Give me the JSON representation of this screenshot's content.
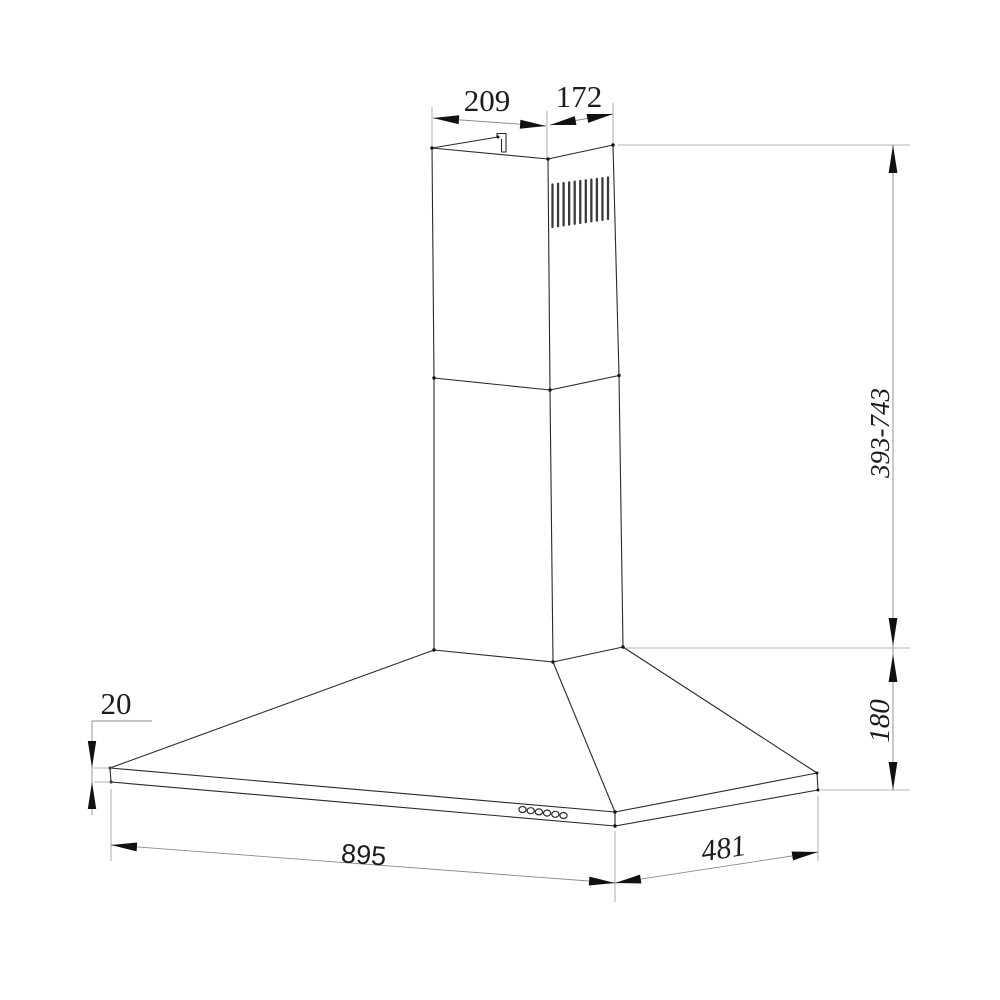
{
  "page": {
    "background": "#ffffff",
    "line_color": "#2a2a2a",
    "dimension_line_color": "#8a8a8a",
    "arrow_color": "#111111"
  },
  "drawing": {
    "title": "chimney-range-hood-dimension-drawing",
    "dimensions": {
      "chimney_top_width": "209",
      "chimney_top_depth": "172",
      "chimney_height_range": "393-743",
      "hood_body_height": "180",
      "rim_height": "20",
      "hood_width": "895",
      "hood_depth": "481"
    },
    "features": {
      "vent_slat_count": 11,
      "control_button_count": 6
    }
  }
}
